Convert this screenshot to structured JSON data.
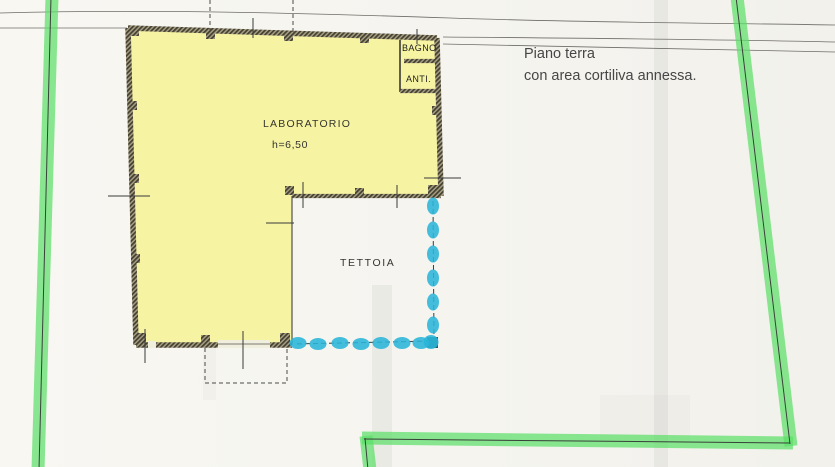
{
  "plan": {
    "title": {
      "line1": "Piano terra",
      "line2": "con area cortiliva annessa."
    },
    "labels": {
      "laboratorio": "LABORATORIO",
      "laboratorio_height": "h=6,50",
      "bagno": "BAGNO",
      "anti": "ANTI.",
      "tettoia": "TETTOIA"
    },
    "colors": {
      "building_fill": "#f6f3a2",
      "boundary_marker": "#5bdf68",
      "courtyard_marker": "#2ab5d8",
      "wall_dark": "#4a463c",
      "paper": "#f6f5f0",
      "ink": "#3c3c3c"
    }
  }
}
